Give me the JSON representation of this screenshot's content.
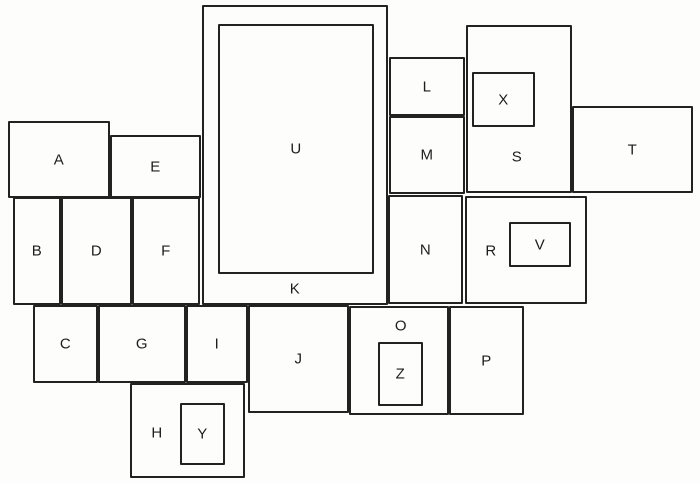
{
  "diagram": {
    "canvas": {
      "width": 700,
      "height": 484,
      "background": "#fdfdfb",
      "line_color": "#222222",
      "text_color": "#1d1d1d"
    },
    "rectangles": [
      {
        "label": "A",
        "x": 8,
        "y": 121,
        "w": 102,
        "h": 77
      },
      {
        "label": "E",
        "x": 110,
        "y": 135,
        "w": 91,
        "h": 63
      },
      {
        "label": "K",
        "x": 202,
        "y": 5,
        "w": 186,
        "h": 300,
        "label_x": 295,
        "label_y": 289
      },
      {
        "label": "U",
        "x": 218,
        "y": 24,
        "w": 156,
        "h": 250
      },
      {
        "label": "L",
        "x": 389,
        "y": 57,
        "w": 76,
        "h": 59
      },
      {
        "label": "M",
        "x": 389,
        "y": 116,
        "w": 76,
        "h": 78
      },
      {
        "label": "S",
        "x": 466,
        "y": 25,
        "w": 106,
        "h": 168,
        "label_x": 517,
        "label_y": 157
      },
      {
        "label": "X",
        "x": 472,
        "y": 72,
        "w": 63,
        "h": 55
      },
      {
        "label": "T",
        "x": 572,
        "y": 106,
        "w": 121,
        "h": 87
      },
      {
        "label": "B",
        "x": 13,
        "y": 197,
        "w": 48,
        "h": 108
      },
      {
        "label": "D",
        "x": 61,
        "y": 197,
        "w": 71,
        "h": 108
      },
      {
        "label": "F",
        "x": 132,
        "y": 197,
        "w": 68,
        "h": 108
      },
      {
        "label": "N",
        "x": 388,
        "y": 195,
        "w": 75,
        "h": 109
      },
      {
        "label": "R",
        "x": 465,
        "y": 196,
        "w": 122,
        "h": 108,
        "label_x": 491,
        "label_y": 251
      },
      {
        "label": "V",
        "x": 509,
        "y": 222,
        "w": 62,
        "h": 45
      },
      {
        "label": "C",
        "x": 33,
        "y": 305,
        "w": 65,
        "h": 78
      },
      {
        "label": "G",
        "x": 98,
        "y": 305,
        "w": 88,
        "h": 78
      },
      {
        "label": "I",
        "x": 186,
        "y": 305,
        "w": 62,
        "h": 78
      },
      {
        "label": "J",
        "x": 248,
        "y": 305,
        "w": 101,
        "h": 108
      },
      {
        "label": "O",
        "x": 349,
        "y": 306,
        "w": 100,
        "h": 109,
        "label_x": 401,
        "label_y": 326
      },
      {
        "label": "Z",
        "x": 378,
        "y": 342,
        "w": 45,
        "h": 64
      },
      {
        "label": "P",
        "x": 449,
        "y": 306,
        "w": 75,
        "h": 109
      },
      {
        "label": "H",
        "x": 130,
        "y": 383,
        "w": 115,
        "h": 95,
        "label_x": 157,
        "label_y": 433
      },
      {
        "label": "Y",
        "x": 180,
        "y": 403,
        "w": 45,
        "h": 62
      }
    ]
  }
}
